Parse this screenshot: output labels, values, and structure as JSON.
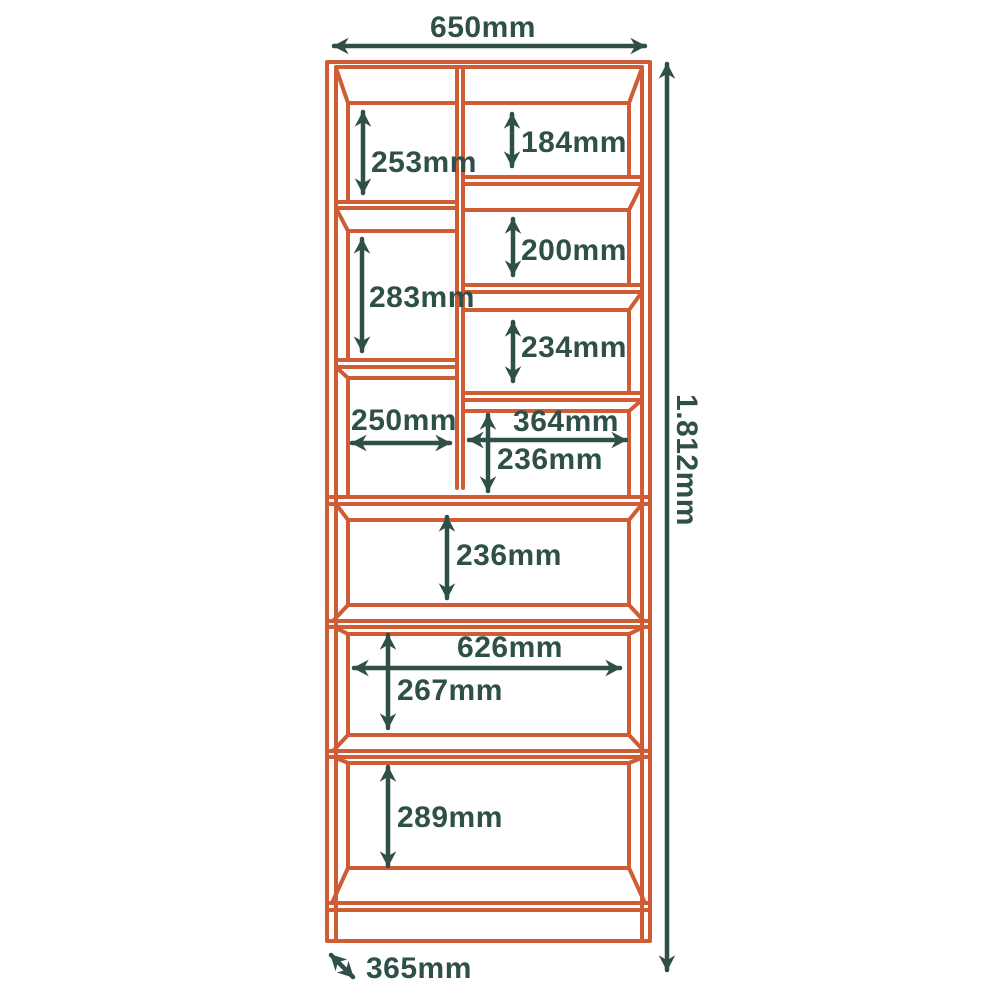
{
  "diagram": {
    "type": "furniture-dimension-diagram",
    "subject": "bookcase front elevation with shelf dimensions",
    "unit": "mm",
    "colors": {
      "outline": "#cf5c34",
      "dimension": "#2e5049",
      "background": "#ffffff"
    },
    "overall": {
      "width": "650mm",
      "height": "1.812mm",
      "depth": "365mm"
    },
    "compartments": {
      "left_column": [
        {
          "height": "253mm"
        },
        {
          "height": "283mm"
        },
        {
          "width": "250mm"
        }
      ],
      "right_column": [
        {
          "height": "184mm"
        },
        {
          "height": "200mm"
        },
        {
          "height": "234mm"
        },
        {
          "width": "364mm",
          "height": "236mm"
        }
      ],
      "full_width": [
        {
          "height": "236mm"
        },
        {
          "width": "626mm",
          "height": "267mm"
        },
        {
          "height": "289mm"
        }
      ]
    }
  }
}
